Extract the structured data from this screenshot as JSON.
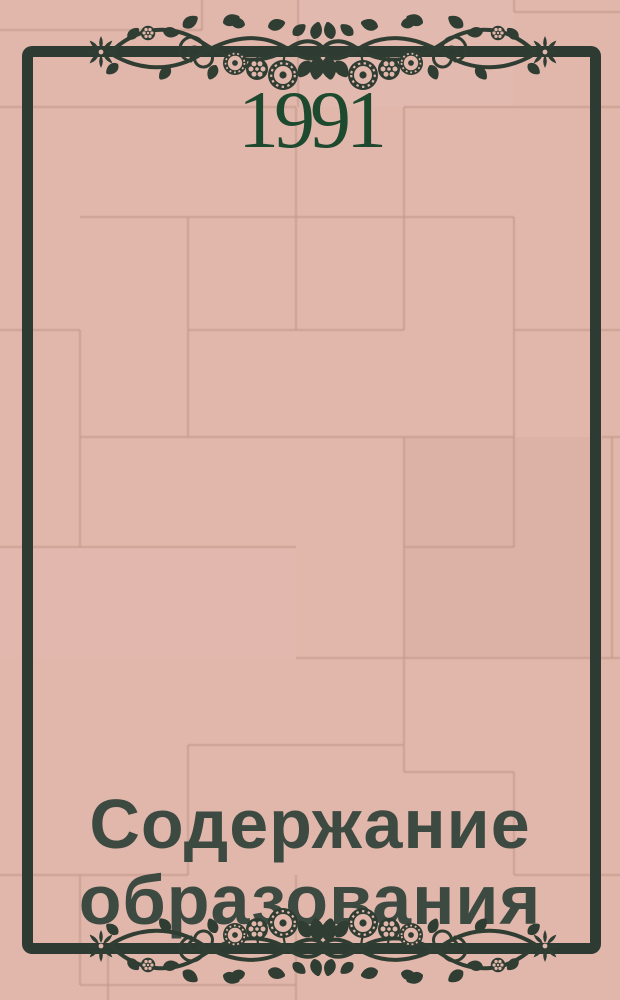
{
  "cover": {
    "year": "1991",
    "title": {
      "line1": "Содержание",
      "line2": "образования",
      "full": "Содержание образования"
    },
    "ornament": {
      "style": "floral-vine-band",
      "positions": [
        "top",
        "bottom"
      ]
    },
    "colors": {
      "background_pink": "#e1b6ab",
      "tile_grout": "#c09588",
      "frame_green": "#2e3b32",
      "ornament_green": "#2f3d32",
      "year_green": "#1d4a2f",
      "title_green": "#3c4a41"
    }
  }
}
